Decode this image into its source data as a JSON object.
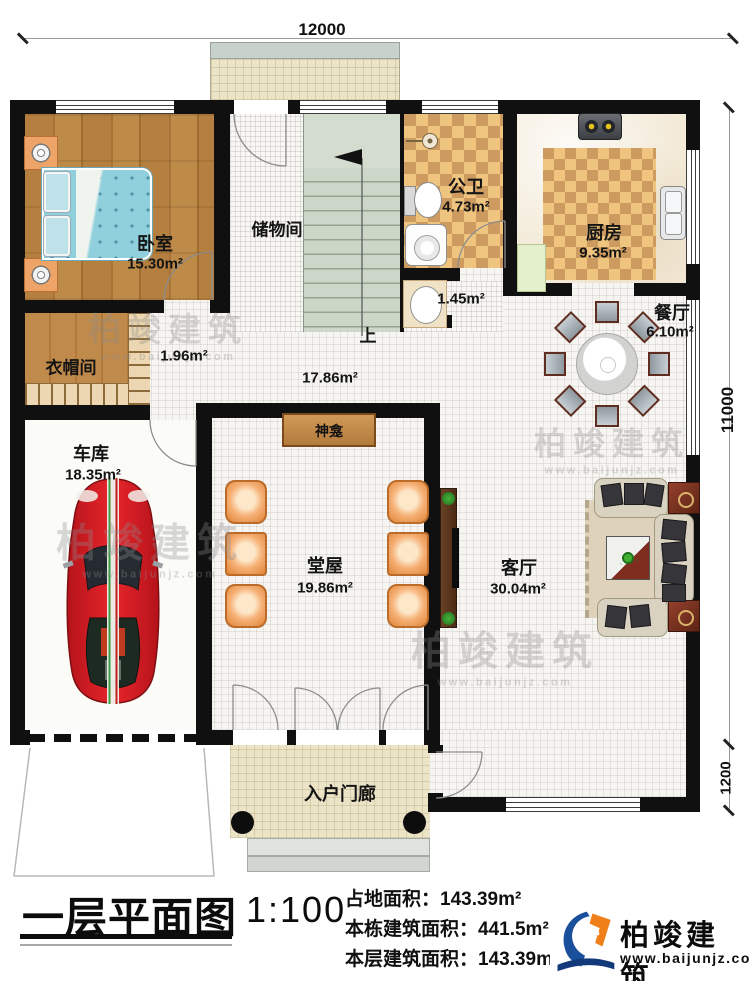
{
  "plan": {
    "dimensions": {
      "top": "12000",
      "right": "11000",
      "right_lower": "1200"
    },
    "rooms": {
      "bedroom": {
        "name": "卧室",
        "area": "15.30m²"
      },
      "storage": {
        "name": "储物间"
      },
      "bath": {
        "name": "公卫",
        "area": "4.73m²"
      },
      "kitchen": {
        "name": "厨房",
        "area": "9.35m²"
      },
      "dining": {
        "name": "餐厅",
        "area": "6.10m²"
      },
      "cloak": {
        "name": "衣帽间",
        "area": "1.96m²"
      },
      "hall": {
        "area": "17.86m²"
      },
      "wash": {
        "area": "1.45m²"
      },
      "garage": {
        "name": "车库",
        "area": "18.35m²"
      },
      "main_hall": {
        "name": "堂屋",
        "area": "19.86m²"
      },
      "living": {
        "name": "客厅",
        "area": "30.04m²"
      },
      "porch": {
        "name": "入户门廊"
      },
      "shrine": {
        "name": "神龛"
      },
      "stairs": {
        "up": "上"
      }
    }
  },
  "watermark": {
    "brand": "柏竣建筑",
    "url": "www.baijunjz.com"
  },
  "footer": {
    "title": "一层平面图",
    "scale": "1:100",
    "land_area": "占地面积：143.39m²",
    "building_area": "本栋建筑面积：441.5m²（含屋顶面积）",
    "floor_area": "本层建筑面积：143.39m²",
    "floor_height": "层高：3.0m",
    "logo_brand": "柏竣建筑",
    "logo_url": "www.baijunjz.com"
  }
}
